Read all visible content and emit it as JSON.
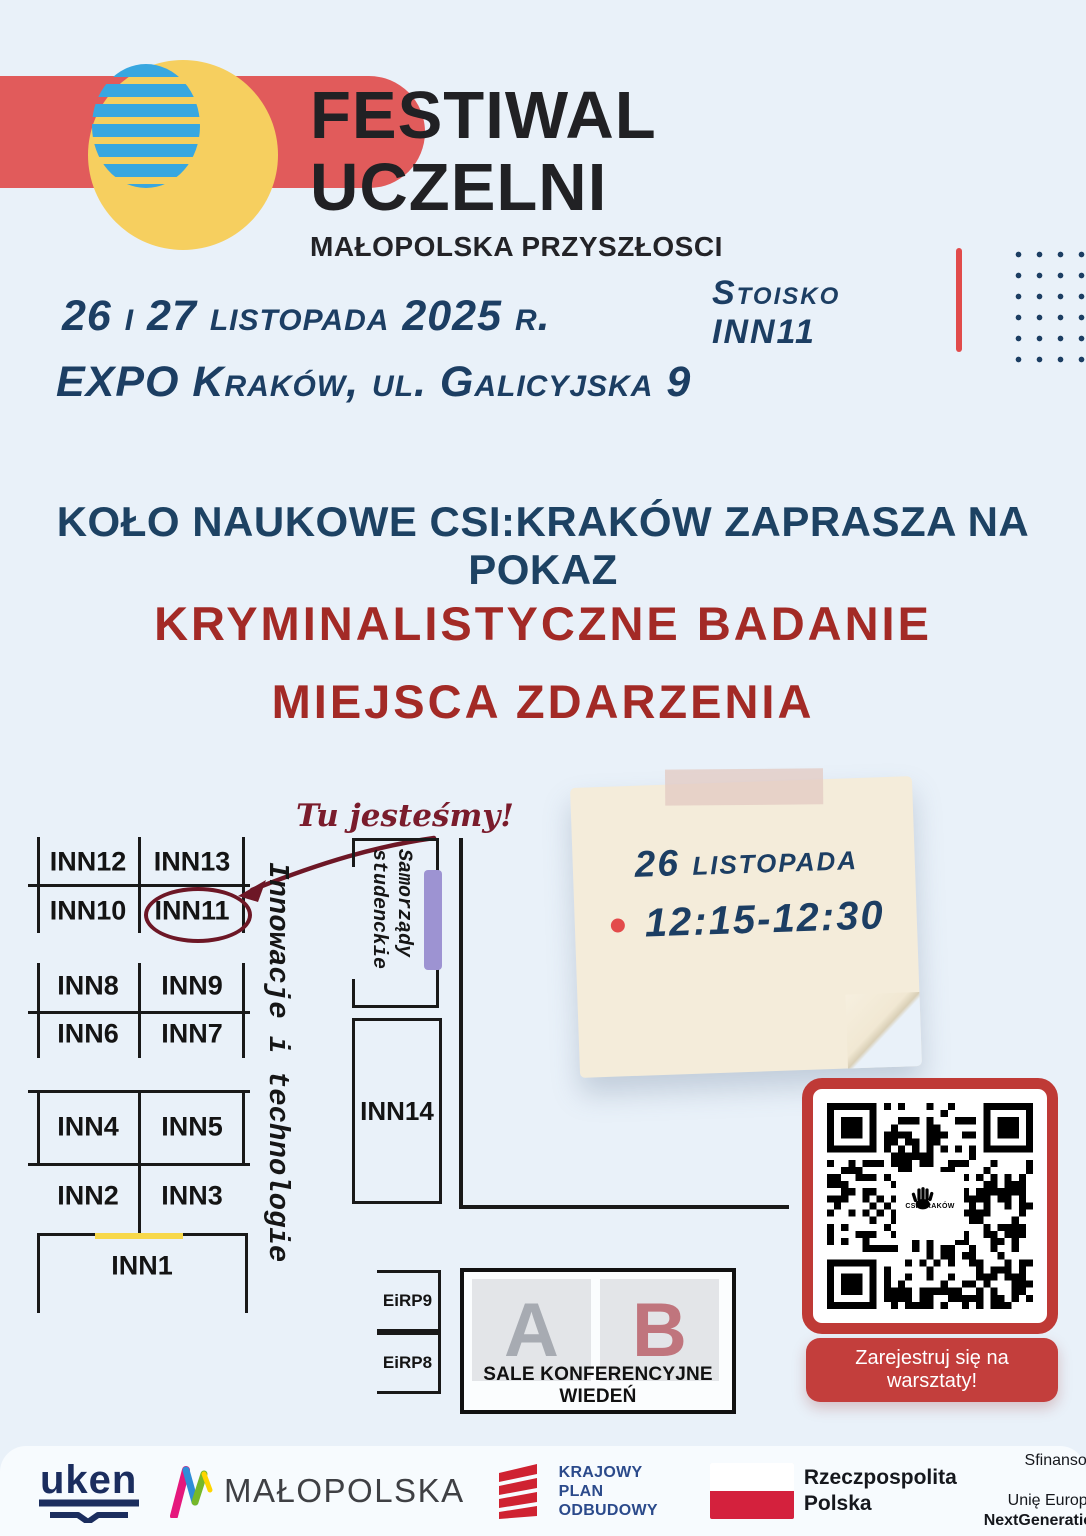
{
  "header": {
    "title_line1": "FESTIWAL",
    "title_line2": "UCZELNI",
    "subtitle": "MAŁOPOLSKA PRZYSZŁOSCI"
  },
  "event": {
    "date": "26 i 27 listopada 2025 r.",
    "venue": "EXPO Kraków, ul. Galicyjska 9",
    "stand": "Stoisko INN11"
  },
  "invitation": {
    "headline": "KOŁO NAUKOWE CSI:KRAKÓW ZAPRASZA NA POKAZ",
    "title_line1": "KRYMINALISTYCZNE BADANIE",
    "title_line2": "MIEJSCA ZDARZENIA"
  },
  "map": {
    "you_are_here": "Tu jesteśmy!",
    "booths": {
      "inn12": "INN12",
      "inn13": "INN13",
      "inn10": "INN10",
      "inn11": "INN11",
      "inn8": "INN8",
      "inn9": "INN9",
      "inn6": "INN6",
      "inn7": "INN7",
      "inn4": "INN4",
      "inn5": "INN5",
      "inn2": "INN2",
      "inn3": "INN3",
      "inn1": "INN1",
      "inn14": "INN14"
    },
    "zone_innovations": "Innowacje i technologie",
    "zone_student_line1": "Samorządy",
    "zone_student_line2": "studenckie",
    "eirp9": "EiRP9",
    "eirp8": "EiRP8",
    "hall_a": "A",
    "hall_b": "B",
    "halls_label": "SALE KONFERENCYJNE WIEDEŃ"
  },
  "note": {
    "date": "26 listopada",
    "time": "12:15-12:30"
  },
  "qr": {
    "label": "CSI:KRAKÓW"
  },
  "cta": {
    "register": "Zarejestruj się na warsztaty!"
  },
  "footer": {
    "uken": "uken",
    "malopolska": "MAŁOPOLSKA",
    "kpo_line1": "KRAJOWY",
    "kpo_line2": "PLAN",
    "kpo_line3": "ODBUDOWY",
    "poland_line1": "Rzeczpospolita",
    "poland_line2": "Polska",
    "eu_line1": "Sfinansowane przez",
    "eu_line2": "Unię Europejską",
    "eu_line3": "NextGenerationEU"
  },
  "colors": {
    "background": "#e9f1f9",
    "accent_red": "#e15b5b",
    "stencil_navy": "#1d4263",
    "stencil_red": "#a32a26",
    "maroon_annotation": "#7a1c2c",
    "navy_text": "#1c3e63",
    "purple_bar": "#9d93d2",
    "qr_frame_red": "#bf3a36",
    "button_red": "#c33e3c",
    "note_bg": "#f4ecda",
    "yellow_circle": "#f6cf5f",
    "blue_stripes": "#38a7e0"
  }
}
